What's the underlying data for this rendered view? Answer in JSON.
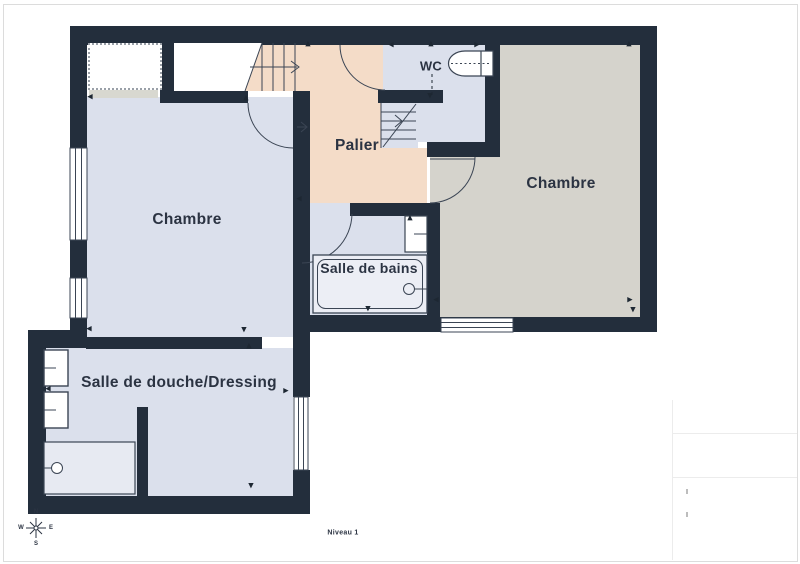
{
  "meta": {
    "level_label": "Niveau 1"
  },
  "rooms": {
    "chambre_left": {
      "label": "Chambre"
    },
    "chambre_right": {
      "label": "Chambre"
    },
    "palier": {
      "label": "Palier"
    },
    "wc": {
      "label": "WC"
    },
    "salle_de_bains": {
      "label": "Salle de bains"
    },
    "salle_de_douche": {
      "label": "Salle de douche/Dressing"
    }
  },
  "compass": {
    "north": "N",
    "south": "S",
    "east": "E",
    "west": "W"
  },
  "fixtures": {
    "wc": [
      "toilet"
    ],
    "salle_de_bains": [
      "sink",
      "bathtub"
    ],
    "salle_de_douche": [
      "sink",
      "sink",
      "shower"
    ]
  },
  "colors": {
    "wall": "#232e3c",
    "room_blue": "#dbe0ec",
    "room_peach": "#f4dcc8",
    "room_gray": "#d5d3cc",
    "line": "#3b4554",
    "text": "#2b3342"
  },
  "ticks": [
    {
      "x": 308,
      "y": 44,
      "t": "▲"
    },
    {
      "x": 431,
      "y": 44,
      "t": "▲"
    },
    {
      "x": 391,
      "y": 45,
      "t": "◀"
    },
    {
      "x": 477,
      "y": 45,
      "t": "▶"
    },
    {
      "x": 629,
      "y": 44,
      "t": "▲"
    },
    {
      "x": 246,
      "y": 98,
      "t": "▲"
    },
    {
      "x": 430,
      "y": 96,
      "t": "▼"
    },
    {
      "x": 90,
      "y": 97,
      "t": "◀"
    },
    {
      "x": 89,
      "y": 329,
      "t": "◀"
    },
    {
      "x": 244,
      "y": 330,
      "t": "▼"
    },
    {
      "x": 249,
      "y": 346,
      "t": "▲"
    },
    {
      "x": 286,
      "y": 391,
      "t": "▶"
    },
    {
      "x": 251,
      "y": 486,
      "t": "▼"
    },
    {
      "x": 48,
      "y": 389,
      "t": "◀"
    },
    {
      "x": 410,
      "y": 218,
      "t": "▲"
    },
    {
      "x": 368,
      "y": 309,
      "t": "▼"
    },
    {
      "x": 436,
      "y": 300,
      "t": "◀"
    },
    {
      "x": 630,
      "y": 300,
      "t": "▶"
    },
    {
      "x": 633,
      "y": 310,
      "t": "▼"
    },
    {
      "x": 299,
      "y": 199,
      "t": "◀"
    }
  ]
}
